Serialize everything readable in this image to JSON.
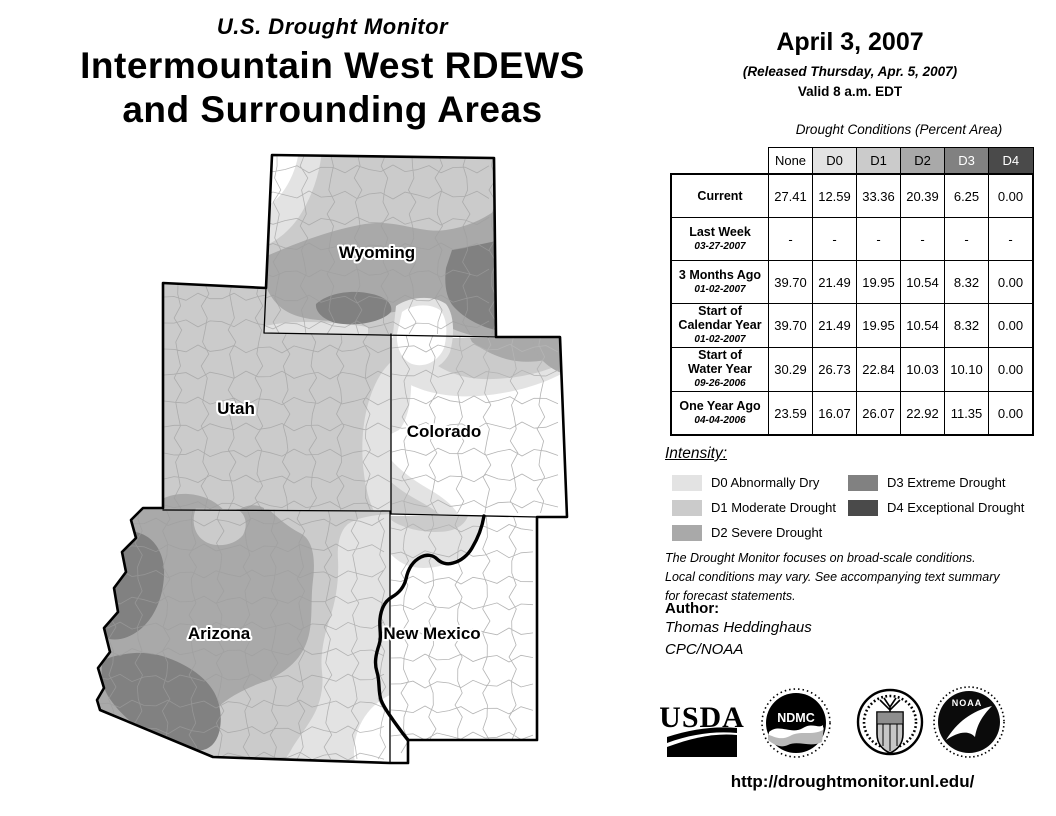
{
  "colors": {
    "none": "#ffffff",
    "d0": "#e3e3e3",
    "d1": "#cbcbcb",
    "d2": "#a9a9a9",
    "d3": "#818181",
    "d4": "#4a4a4a"
  },
  "header": {
    "overtitle": "U.S. Drought Monitor",
    "title_line1": "Intermountain West RDEWS",
    "title_line2": "and Surrounding Areas"
  },
  "date_block": {
    "date": "April 3, 2007",
    "released": "(Released Thursday, Apr. 5, 2007)",
    "valid": "Valid 8 a.m. EDT"
  },
  "map": {
    "state_labels": [
      {
        "name": "Wyoming",
        "x": 377,
        "y": 258
      },
      {
        "name": "Utah",
        "x": 236,
        "y": 414
      },
      {
        "name": "Colorado",
        "x": 444,
        "y": 437
      },
      {
        "name": "Arizona",
        "x": 219,
        "y": 639
      },
      {
        "name": "New Mexico",
        "x": 432,
        "y": 639
      }
    ]
  },
  "table": {
    "caption": "Drought Conditions (Percent Area)",
    "columns": [
      {
        "key": "none",
        "label": "None",
        "text_color": "#000000"
      },
      {
        "key": "d0",
        "label": "D0",
        "text_color": "#000000"
      },
      {
        "key": "d1",
        "label": "D1",
        "text_color": "#000000"
      },
      {
        "key": "d2",
        "label": "D2",
        "text_color": "#000000"
      },
      {
        "key": "d3",
        "label": "D3",
        "text_color": "#ffffff"
      },
      {
        "key": "d4",
        "label": "D4",
        "text_color": "#ffffff"
      }
    ],
    "rows": [
      {
        "label": "Current",
        "sublabel": "",
        "values": [
          "27.41",
          "12.59",
          "33.36",
          "20.39",
          "6.25",
          "0.00"
        ]
      },
      {
        "label": "Last Week",
        "sublabel": "03-27-2007",
        "values": [
          "-",
          "-",
          "-",
          "-",
          "-",
          "-"
        ]
      },
      {
        "label": "3 Months Ago",
        "sublabel": "01-02-2007",
        "values": [
          "39.70",
          "21.49",
          "19.95",
          "10.54",
          "8.32",
          "0.00"
        ]
      },
      {
        "label": "Start of\nCalendar Year",
        "sublabel": "01-02-2007",
        "values": [
          "39.70",
          "21.49",
          "19.95",
          "10.54",
          "8.32",
          "0.00"
        ]
      },
      {
        "label": "Start of\nWater Year",
        "sublabel": "09-26-2006",
        "values": [
          "30.29",
          "26.73",
          "22.84",
          "10.03",
          "10.10",
          "0.00"
        ]
      },
      {
        "label": "One Year Ago",
        "sublabel": "04-04-2006",
        "values": [
          "23.59",
          "16.07",
          "26.07",
          "22.92",
          "11.35",
          "0.00"
        ]
      }
    ]
  },
  "legend": {
    "heading": "Intensity:",
    "items": [
      {
        "key": "d0",
        "label": "D0 Abnormally Dry",
        "col": 1
      },
      {
        "key": "d1",
        "label": "D1 Moderate Drought",
        "col": 1
      },
      {
        "key": "d2",
        "label": "D2 Severe Drought",
        "col": 1
      },
      {
        "key": "d3",
        "label": "D3 Extreme Drought",
        "col": 2
      },
      {
        "key": "d4",
        "label": "D4 Exceptional Drought",
        "col": 2
      }
    ]
  },
  "disclaimer": "The Drought Monitor focuses on broad-scale conditions.\nLocal conditions may vary. See accompanying text summary\nfor forecast statements.",
  "author": {
    "heading": "Author:",
    "name": "Thomas Heddinghaus",
    "org": "CPC/NOAA"
  },
  "logos": {
    "usda": "USDA",
    "ndmc": "NDMC",
    "noaa": "NOAA"
  },
  "url": "http://droughtmonitor.unl.edu/",
  "chart_data": {
    "type": "table",
    "title": "Drought Conditions (Percent Area)",
    "columns": [
      "None",
      "D0",
      "D1",
      "D2",
      "D3",
      "D4"
    ],
    "rows": [
      {
        "label": "Current",
        "values": [
          27.41,
          12.59,
          33.36,
          20.39,
          6.25,
          0.0
        ]
      },
      {
        "label": "Last Week 03-27-2007",
        "values": [
          null,
          null,
          null,
          null,
          null,
          null
        ]
      },
      {
        "label": "3 Months Ago 01-02-2007",
        "values": [
          39.7,
          21.49,
          19.95,
          10.54,
          8.32,
          0.0
        ]
      },
      {
        "label": "Start of Calendar Year 01-02-2007",
        "values": [
          39.7,
          21.49,
          19.95,
          10.54,
          8.32,
          0.0
        ]
      },
      {
        "label": "Start of Water Year 09-26-2006",
        "values": [
          30.29,
          26.73,
          22.84,
          10.03,
          10.1,
          0.0
        ]
      },
      {
        "label": "One Year Ago 04-04-2006",
        "values": [
          23.59,
          16.07,
          26.07,
          22.92,
          11.35,
          0.0
        ]
      }
    ]
  }
}
